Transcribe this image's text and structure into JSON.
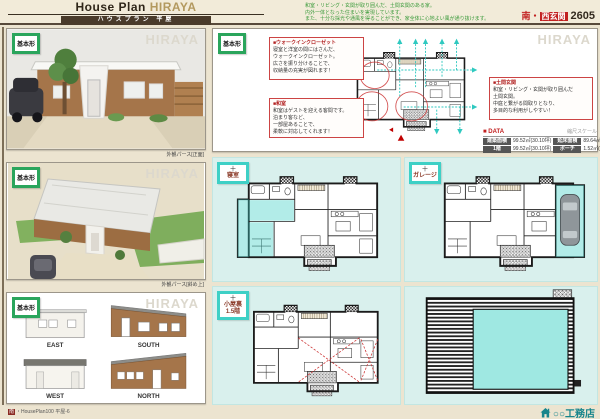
{
  "colors": {
    "accent_green": "#2aa55c",
    "accent_teal": "#3fcfc7",
    "accent_red": "#c22020",
    "brand_tan": "#b3995f",
    "page_cream": "#ece4d0"
  },
  "labels": {
    "basic": "基本形",
    "watermark": "HIRAYA"
  },
  "header": {
    "brand_prefix": "House Plan ",
    "brand_accent": "HIRAYA",
    "subtitle": "ハウスプラン 平屋",
    "notes": [
      "和室・リビング・玄関が取り囲んだ、土間玄関のある家。",
      "内外一体となった住まいを実現しています。",
      "また、十分な採光や通風を得ることができ、家全体に心地よい風が通り抜けます。"
    ],
    "tag": {
      "south": "南・",
      "badge": "西玄関",
      "number": "2605"
    }
  },
  "renders": {
    "front_caption": "外観パース[正面]",
    "aerial_caption": "外観パース[斜め上]"
  },
  "elevations": [
    "EAST",
    "SOUTH",
    "WEST",
    "NORTH"
  ],
  "annotations": {
    "wic": {
      "title": "■ウォークインクローゼット",
      "lines": [
        "寝室と洋室の間にはさんだ、",
        "ウォークインクローゼット。",
        "広さを振り分けることで、",
        "収納量の充実が図れます！"
      ]
    },
    "washitsu": {
      "title": "■和室",
      "lines": [
        "和室はゲストを迎える客間です。",
        "泊まり客など、",
        "一部屋あることで、",
        "柔軟に対応してくれます！"
      ]
    },
    "doma": {
      "title": "■土間玄関",
      "lines": [
        "和室・リビング・玄関が取り囲んだ",
        "土間玄関。",
        "中庭と繋がる間取りとなり、",
        "多目的な利用がしやすい！"
      ]
    }
  },
  "data_table": {
    "title": "■ DATA",
    "note": "縮尺スケール",
    "r1c1": "建築面積",
    "r1v1": "99.52㎡(30.10坪)",
    "r1c2": "延床面積",
    "r1v2": "89.64㎡(27.11坪)",
    "r2c1": "1階",
    "r2v1": "99.52㎡(30.10坪)",
    "r2c2": "ポーチ",
    "r2v2": "1.52㎡(0.45坪)"
  },
  "variants": {
    "bedroom": {
      "plus": "＋",
      "name": "寝室"
    },
    "garage": {
      "plus": "＋",
      "name": "ガレージ"
    },
    "attic": {
      "plus": "＋",
      "name": "小屋裏",
      "name2": "1.5階"
    }
  },
  "footers": {
    "left_badge": "南",
    "left_text": "・HousePlan100 平屋-6",
    "company": "○○工務店"
  }
}
